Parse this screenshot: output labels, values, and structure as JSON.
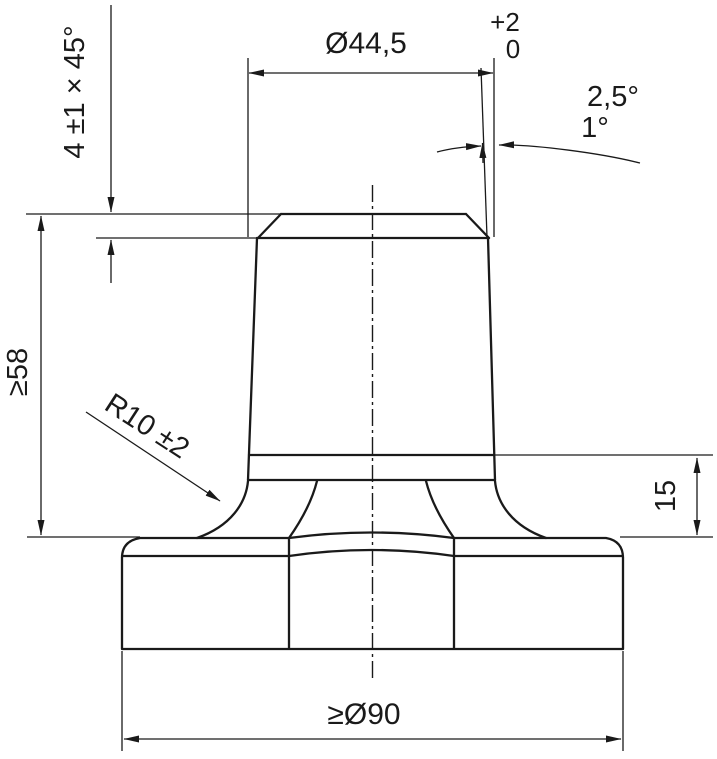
{
  "drawing": {
    "type": "technical-drawing",
    "colors": {
      "line": "#1a1a1a",
      "background": "#ffffff"
    },
    "labels": {
      "chamfer": "4 ±1 × 45°",
      "diameter_top": "Ø44,5",
      "diameter_top_tol_upper": "+2",
      "diameter_top_tol_lower": "0",
      "draft_angle_max": "2,5°",
      "draft_angle_min": "1°",
      "height_total": "≥58",
      "fillet_radius": "R10 ±2",
      "flange_height": "15",
      "diameter_base": "≥Ø90"
    }
  }
}
